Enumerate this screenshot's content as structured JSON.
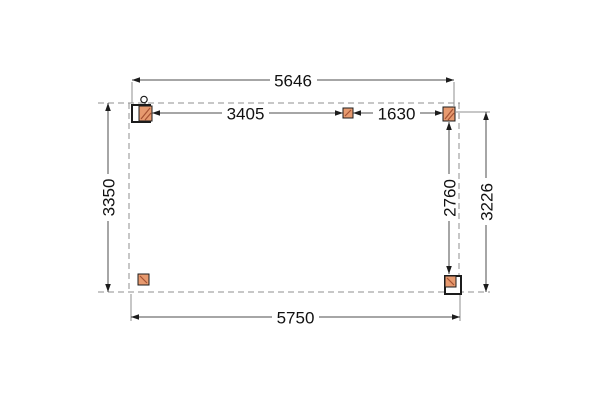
{
  "drawing": {
    "kind": "veranda-floor-plan-top-view",
    "dimensions_mm": {
      "top_total_width": "5646",
      "top_span_left": "3405",
      "top_span_right": "1630",
      "left_depth": "3350",
      "right_post_depth": "2760",
      "right_total_depth": "3226",
      "bottom_total_width": "5750"
    },
    "colors": {
      "post_fill": "#e79a6f",
      "post_hatch": "#a65233",
      "dashed_outline": "#8f8f8f",
      "dimension_line": "#4d4d4d",
      "marker_outline": "#1c1c1c",
      "text": "#111111",
      "background": "#ffffff"
    }
  }
}
